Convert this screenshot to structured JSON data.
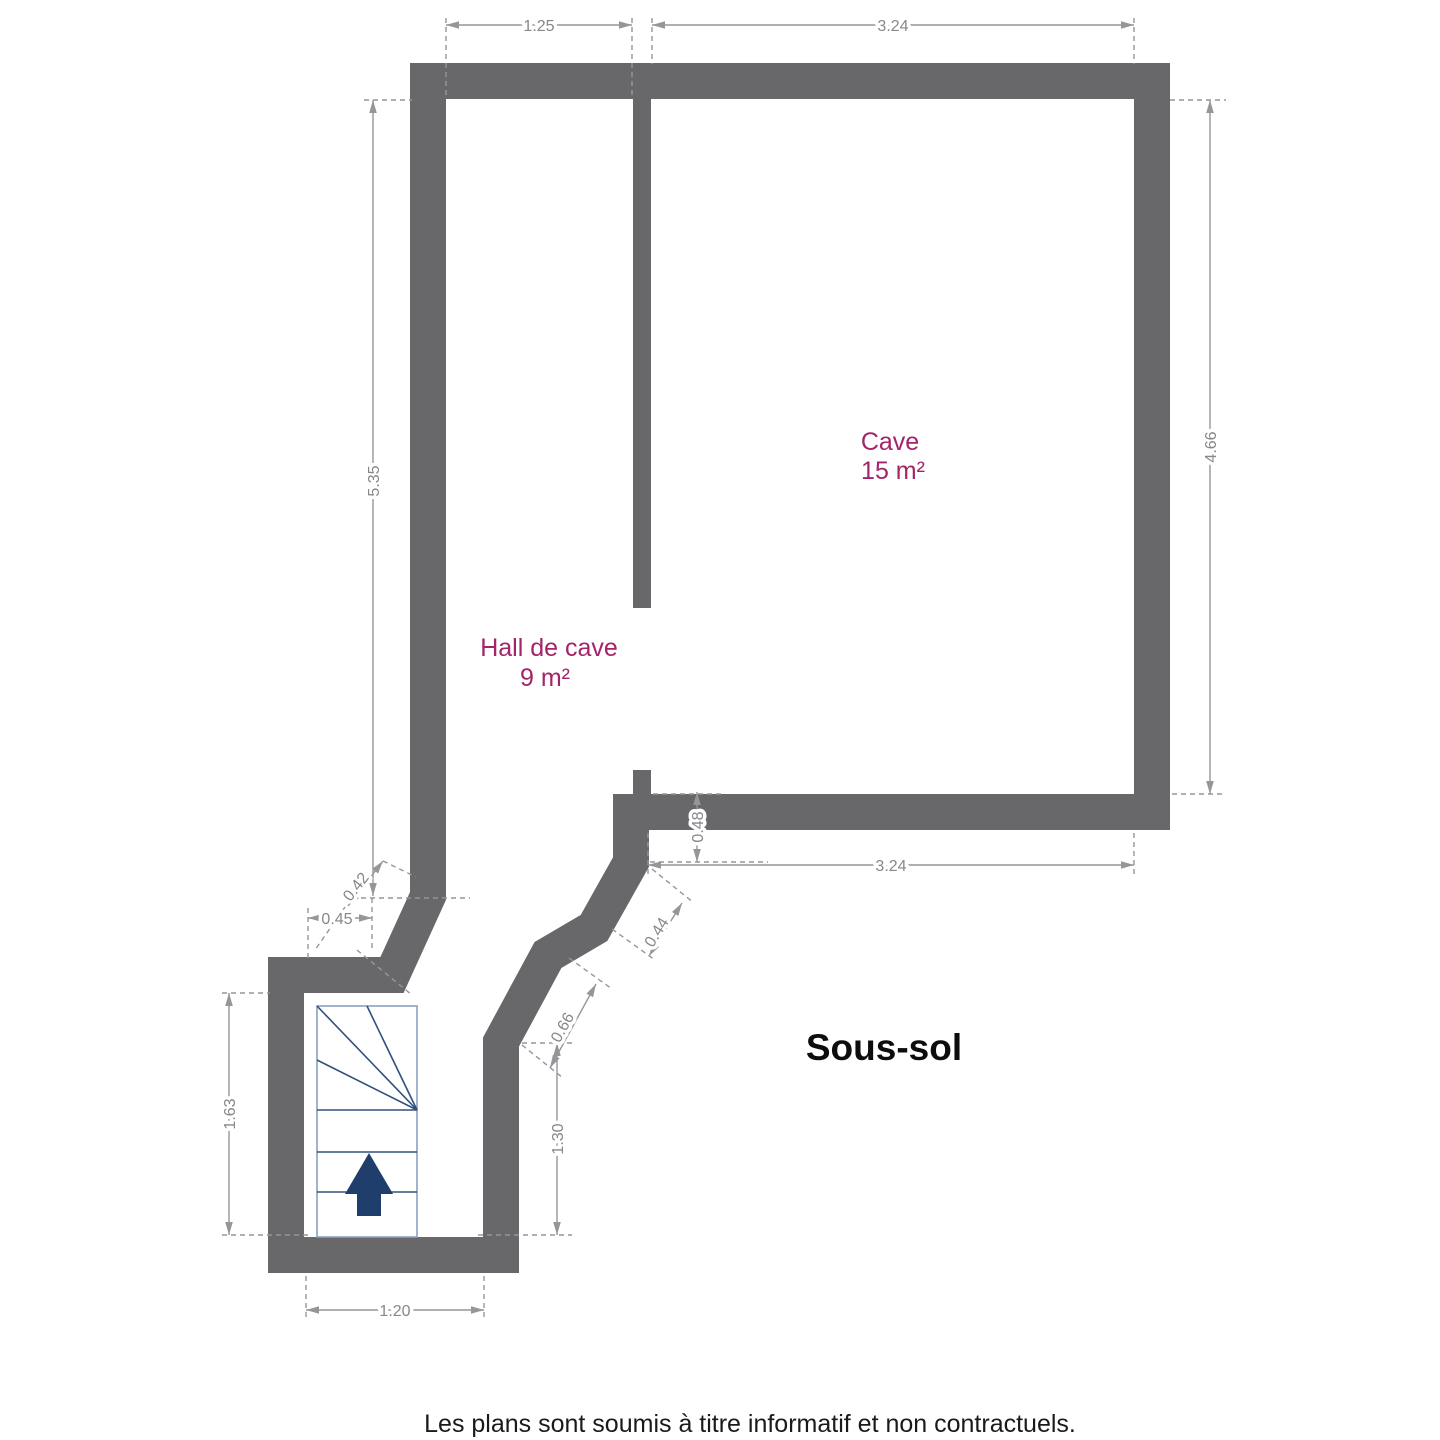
{
  "title": "Sous-sol",
  "footer": "Les plans sont soumis à titre informatif et non contractuels.",
  "rooms": {
    "cave": {
      "name": "Cave",
      "area": "15 m²"
    },
    "hall": {
      "name": "Hall de cave",
      "area": "9 m²"
    }
  },
  "dims": {
    "top_hall_width": "1.25",
    "top_cave_width": "3.24",
    "hall_height": "5.35",
    "cave_height": "4.66",
    "cave_wall_offset": "0.48",
    "cave_bottom_width": "3.24",
    "hall_notch_width": "0.45",
    "hall_diagonal": "0.42",
    "stair_room_height": "1.63",
    "stair_room_width": "1.20",
    "corridor_height": "1.30",
    "corridor_diagonal": "0.66",
    "passage_diagonal": "0.44"
  },
  "colors": {
    "wall": "#68686b",
    "dim": "#96969a",
    "dim_text": "#87878b",
    "room_label": "#a42369",
    "title": "#0d0d0d",
    "footer": "#1a1a1a",
    "stair_border": "#8aa0bf",
    "stair_line": "#30507e",
    "stair_arrow": "#1f3e6b",
    "background": "#ffffff"
  }
}
